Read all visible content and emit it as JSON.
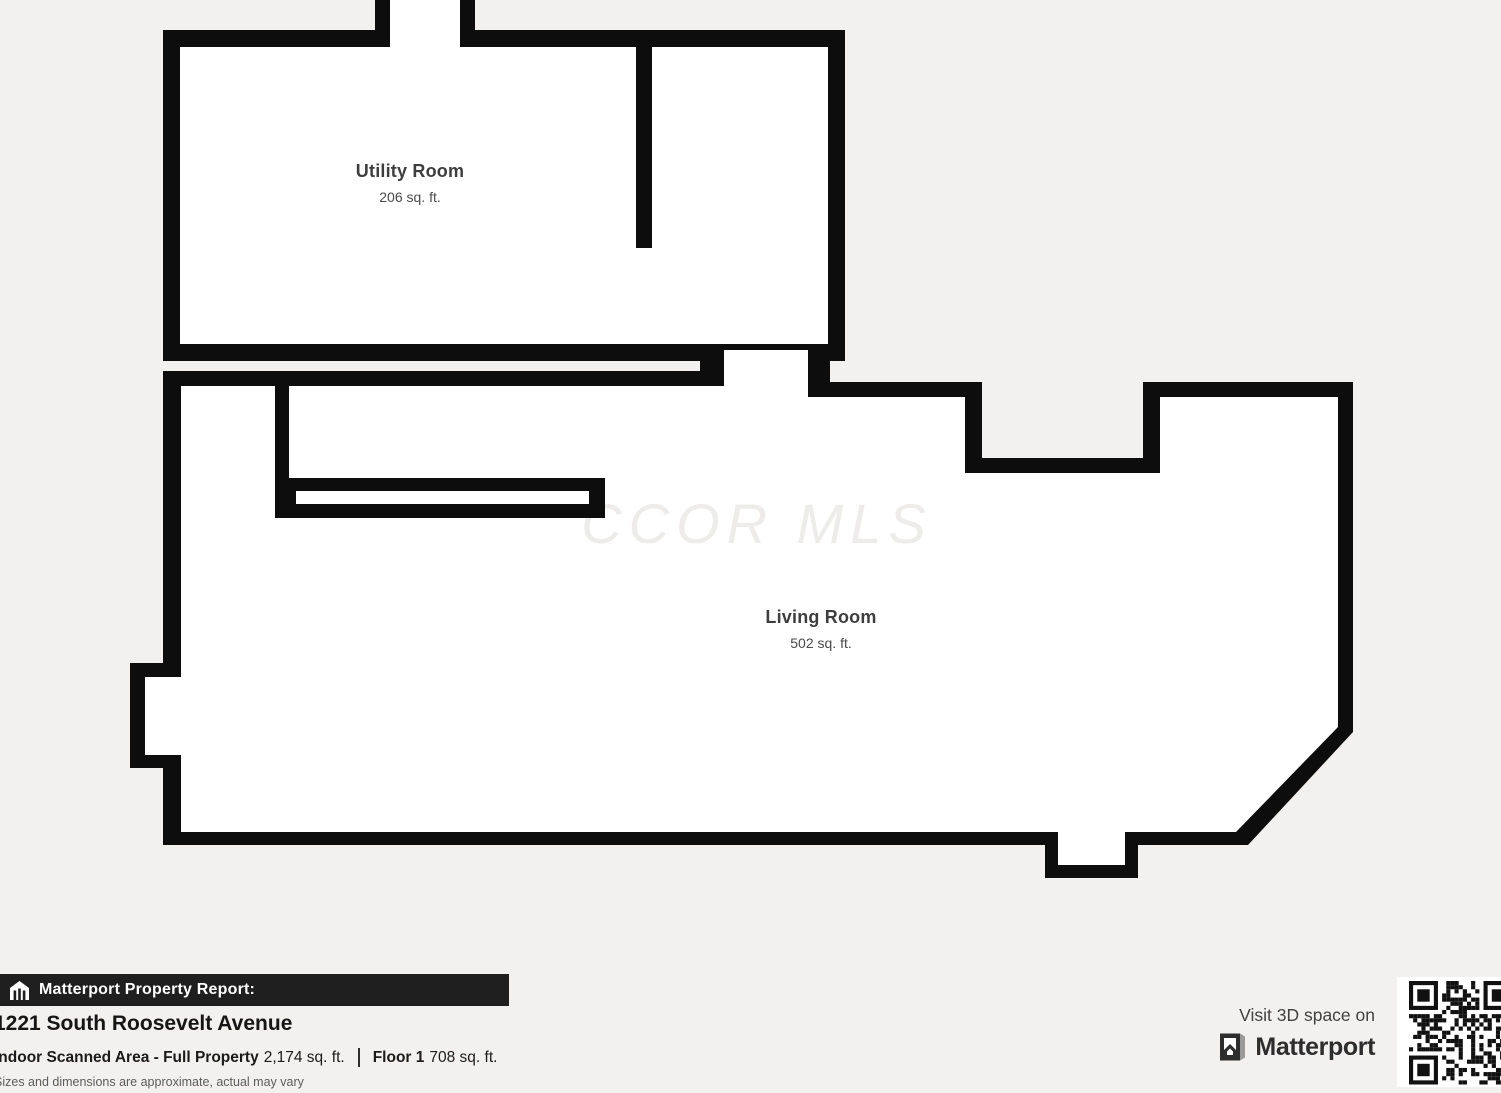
{
  "floor_plan": {
    "watermark": "CCOR MLS",
    "rooms": [
      {
        "name": "Utility Room",
        "area": "206 sq. ft."
      },
      {
        "name": "Living Room",
        "area": "502 sq. ft."
      }
    ]
  },
  "footer": {
    "report_title": "Matterport Property Report:",
    "address": "1221 South Roosevelt Avenue",
    "area_label": "Indoor Scanned Area - Full Property",
    "area_value": "2,174 sq. ft.",
    "floor_label": "Floor 1",
    "floor_value": "708 sq. ft.",
    "disclaimer": "Sizes and dimensions are approximate, actual may vary"
  },
  "promo": {
    "visit_text": "Visit 3D space on",
    "brand": "Matterport"
  },
  "colors": {
    "background": "#f2f1ef",
    "wall": "#0d0d0d",
    "room_fill": "#ffffff",
    "banner_bg": "#1f1f1f",
    "text_dark": "#1b1b1b",
    "text_gray": "#5c5c5c",
    "watermark": "#edecea"
  }
}
